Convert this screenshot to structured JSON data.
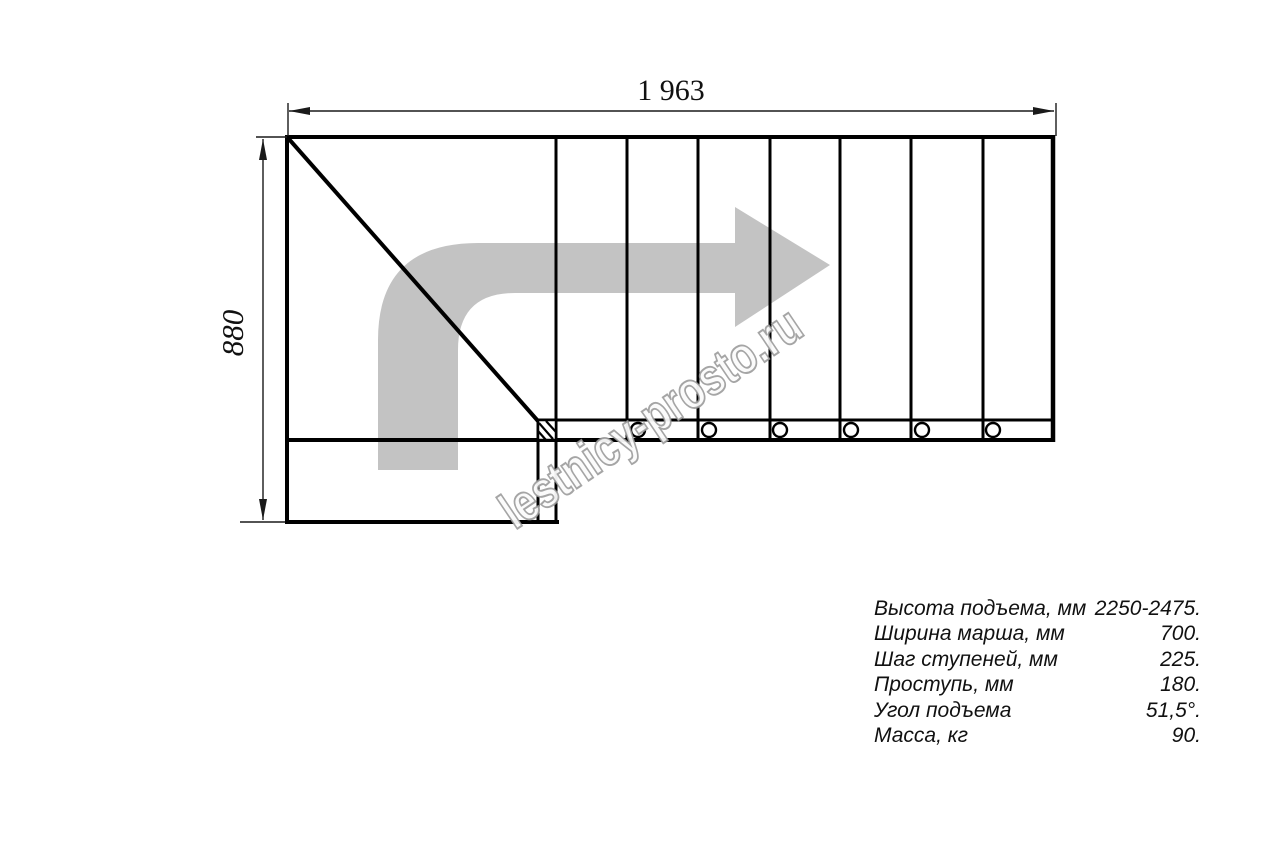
{
  "drawing": {
    "top_dimension_label": "1 963",
    "left_dimension_label": "880"
  },
  "watermark_text": "lestnicy-prosto.ru",
  "specs": {
    "rows": [
      {
        "label": "Высота подъема, мм",
        "value": "2250-2475."
      },
      {
        "label": "Ширина марша, мм",
        "value": "700."
      },
      {
        "label": "Шаг ступеней, мм",
        "value": "225."
      },
      {
        "label": "Проступь, мм",
        "value": "180."
      },
      {
        "label": "Угол подъема",
        "value": "51,5°."
      },
      {
        "label": "Масса, кг",
        "value": "90."
      }
    ]
  },
  "colors": {
    "line": "#000000",
    "direction_arrow": "#c3c3c3",
    "watermark_outline": "#969696",
    "text": "#111111"
  }
}
